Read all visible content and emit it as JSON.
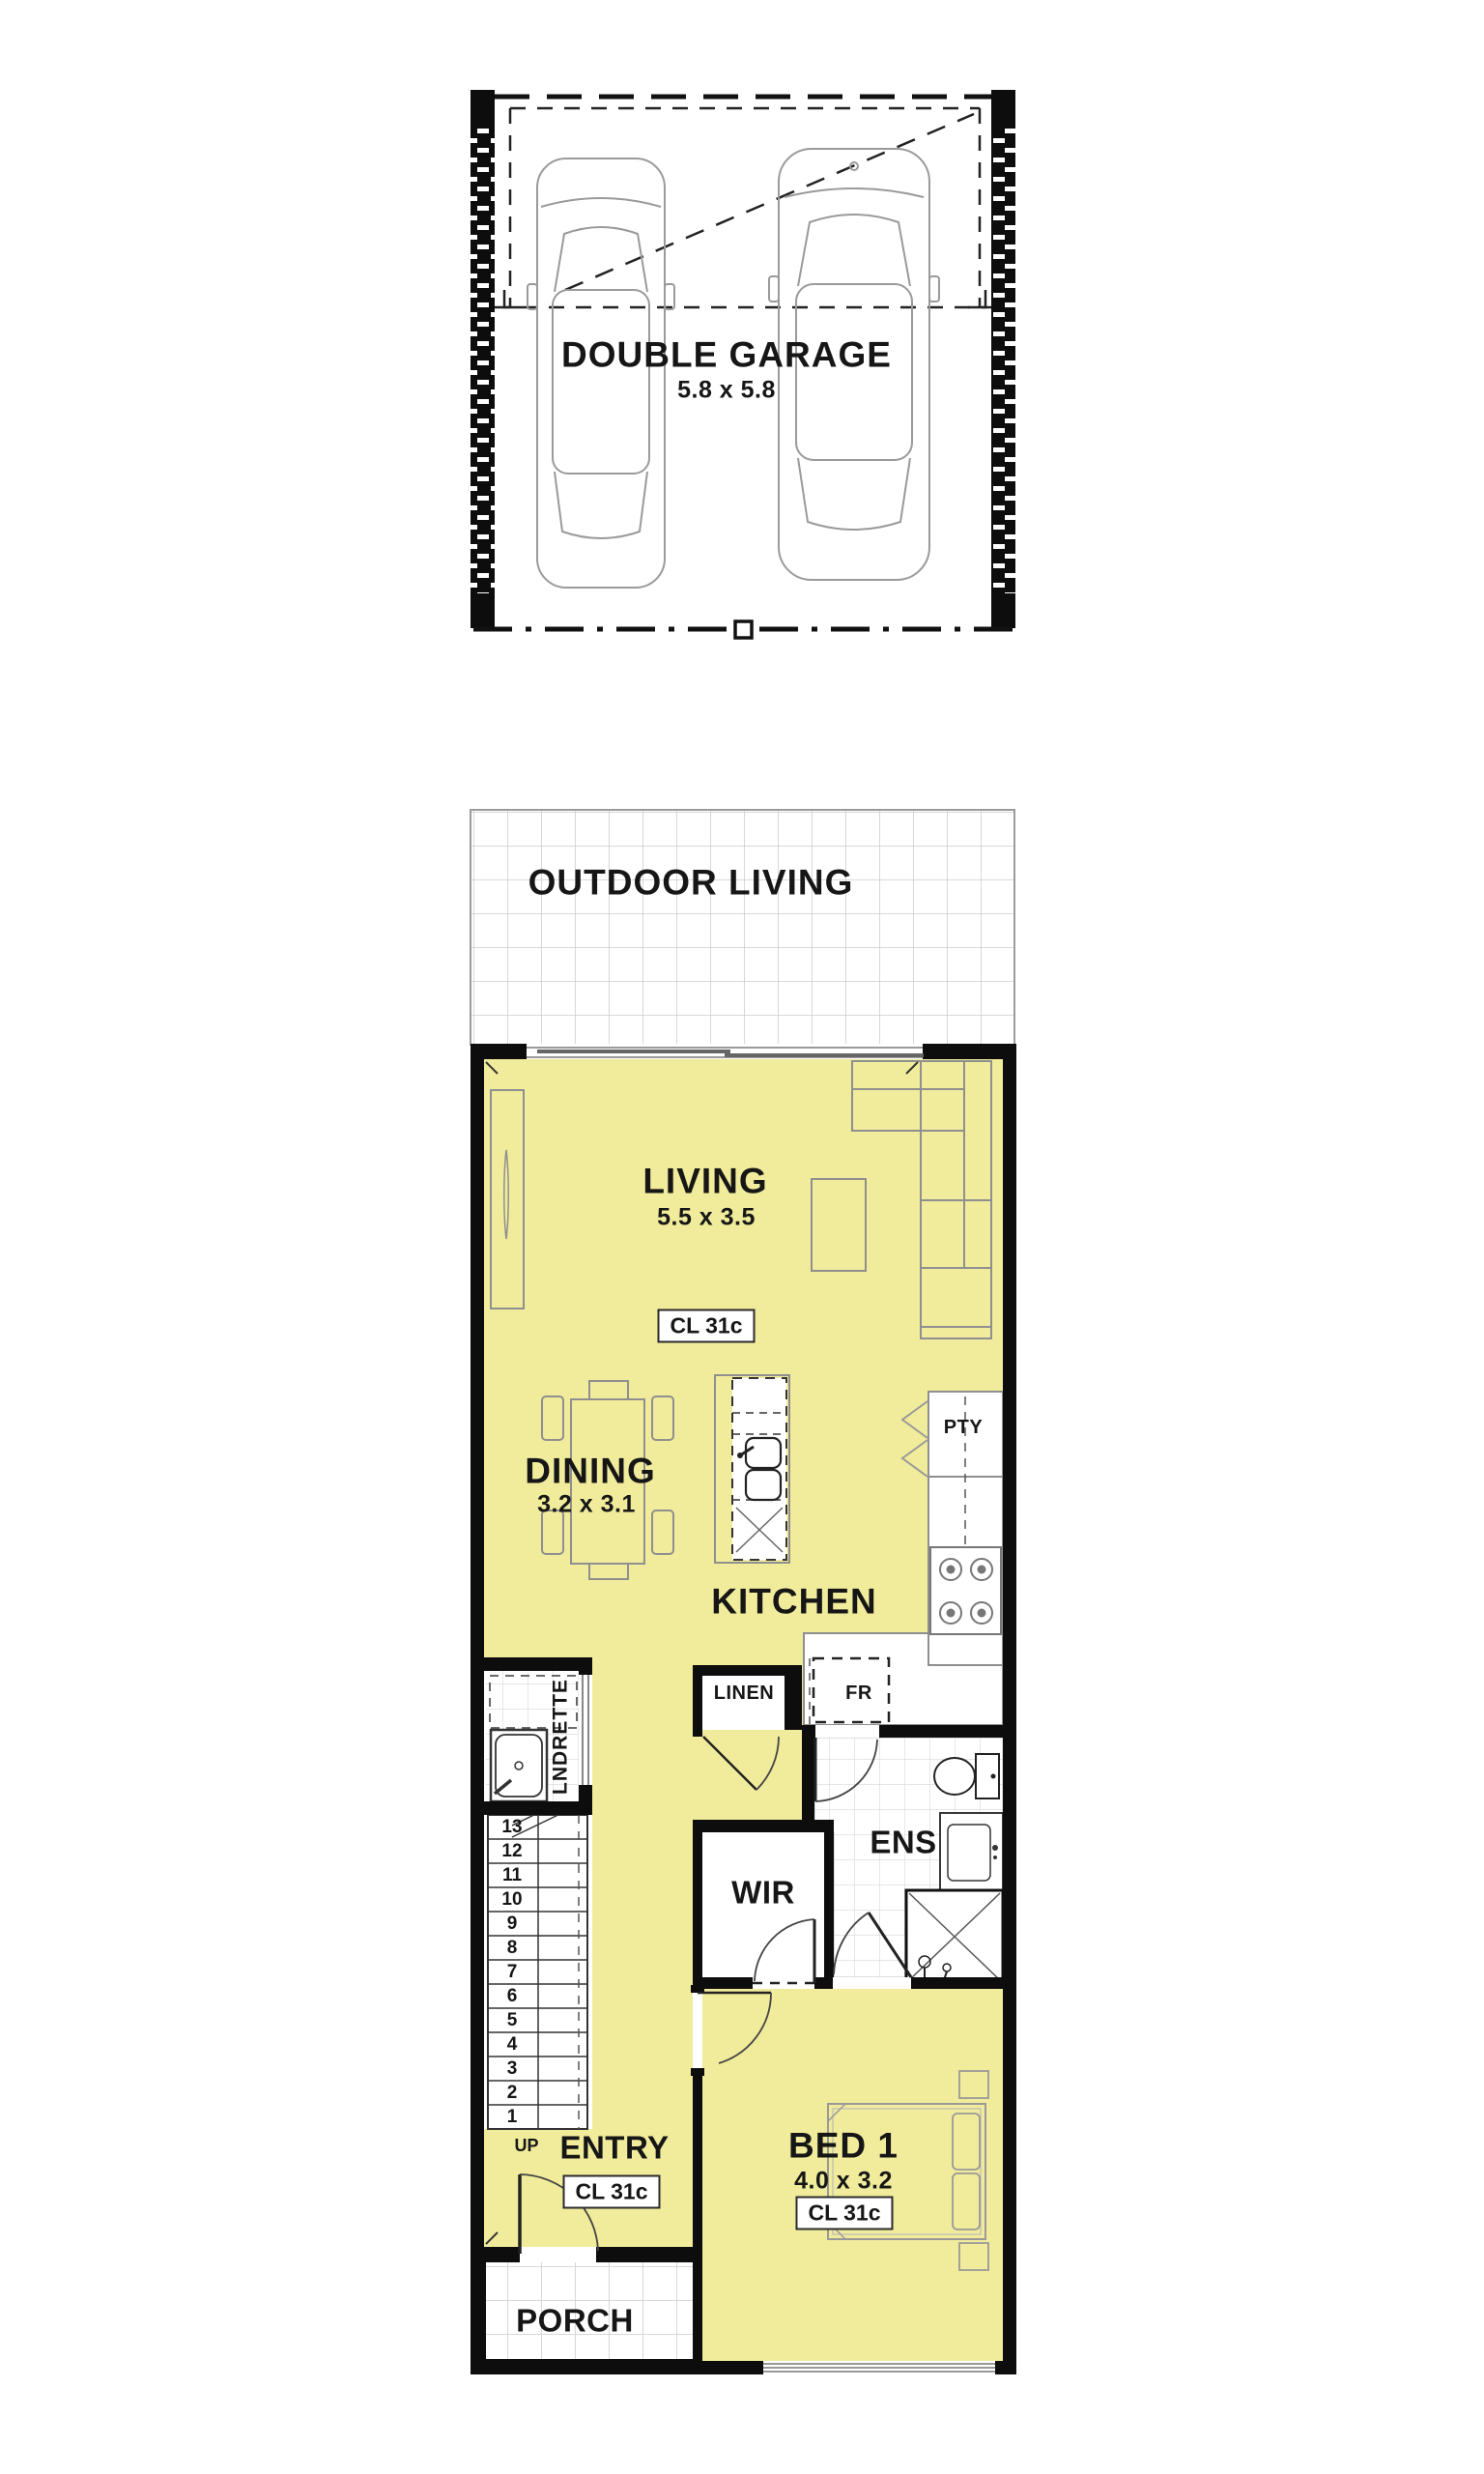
{
  "palette": {
    "floor_yellow": "#f1ec9b",
    "wall_black": "#0d0d0d",
    "tile_line": "#cbcbcb",
    "furniture_gray": "#8f8f8f"
  },
  "garage": {
    "label": "DOUBLE GARAGE",
    "dims": "5.8 x 5.8"
  },
  "outdoor_living": {
    "label": "OUTDOOR LIVING"
  },
  "rooms": {
    "living": {
      "label": "LIVING",
      "dims": "5.5 x 3.5",
      "ceiling_tag": "CL 31c"
    },
    "dining": {
      "label": "DINING",
      "dims": "3.2 x 3.1"
    },
    "kitchen": {
      "label": "KITCHEN",
      "pantry_label": "PTY",
      "fridge_label": "FR"
    },
    "linen": {
      "label": "LINEN"
    },
    "laundrette": {
      "label": "LNDRETTE"
    },
    "ensuite": {
      "label": "ENS"
    },
    "wir": {
      "label": "WIR"
    },
    "bed1": {
      "label": "BED 1",
      "dims": "4.0 x 3.2",
      "ceiling_tag": "CL 31c"
    },
    "entry": {
      "label": "ENTRY",
      "ceiling_tag": "CL 31c",
      "up_label": "UP"
    },
    "porch": {
      "label": "PORCH"
    }
  },
  "stairs": {
    "treads": [
      "13",
      "12",
      "11",
      "10",
      "9",
      "8",
      "7",
      "6",
      "5",
      "4",
      "3",
      "2",
      "1"
    ]
  }
}
